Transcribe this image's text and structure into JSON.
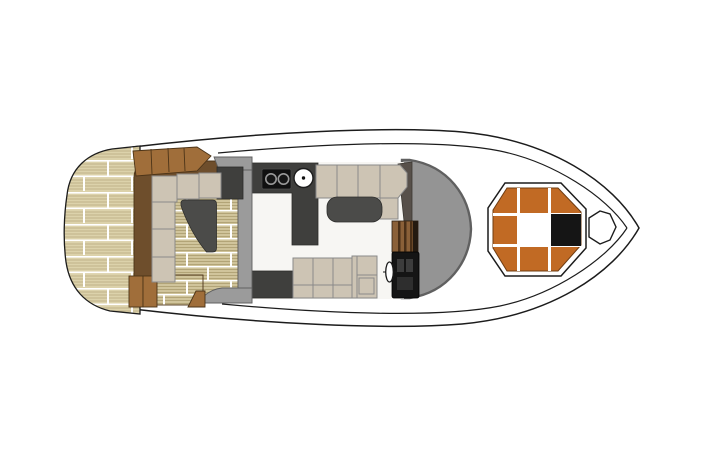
{
  "meta": {
    "title": "yacht-deck-plan",
    "viewBox": "0 0 713 476",
    "width": 713,
    "height": 476
  },
  "palette": {
    "outline": "#1c1c1c",
    "hull_white": "#ffffff",
    "floor_white": "#f7f6f3",
    "teak_light": "#dcd2ab",
    "teak_stripe": "#bfb28a",
    "teak_deck": "#d0c49b",
    "teak_deck_stripe": "#b2a477",
    "teak_seam": "#ffffff",
    "wood_dark": "#6e4e2c",
    "wood_medium": "#a06e3a",
    "wood_edge": "#4c3418",
    "wood_cabinet": "#8a6038",
    "wood_cabinet_dark": "#4a3018",
    "cushion": "#cdc4b4",
    "cushion_line": "#8a8a8a",
    "charcoal": "#3f3f3d",
    "table_dark": "#4b4b49",
    "gray_structure": "#949494",
    "gray_bulkhead": "#9b9b9b",
    "gray_dark": "#606060",
    "wedge_gray": "#57504a",
    "black": "#151515",
    "orange": "#c16a24",
    "sunpad_white": "#ffffff"
  },
  "regions": [
    {
      "id": "swim-platform"
    },
    {
      "id": "aft-cockpit"
    },
    {
      "id": "salon"
    },
    {
      "id": "galley"
    },
    {
      "id": "dinette"
    },
    {
      "id": "helm-station"
    },
    {
      "id": "windshield"
    },
    {
      "id": "bow-sunpad"
    },
    {
      "id": "anchor-locker"
    }
  ],
  "features": {
    "cooktop_burners": 2,
    "cockpit_sofa_cushions": 6,
    "salon_top_sofa_cushions": 5,
    "salon_bottom_sofa_cushions": 3,
    "sunpad_black_hatch": 1
  }
}
